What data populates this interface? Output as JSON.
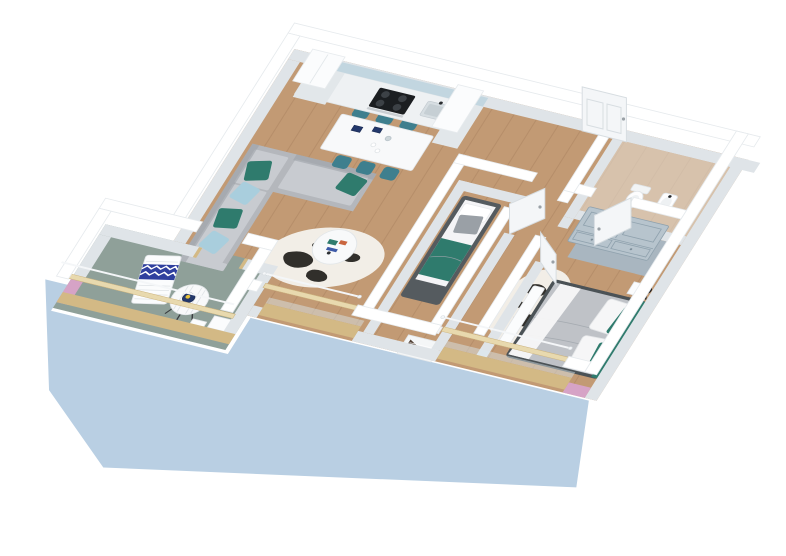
{
  "scene": {
    "label": "3D isometric floor plan render of a two-bedroom apartment with kitchen, living-dining room, child bedroom, master bedroom, bathroom, terrace and two balconies on a light blue walkway slab"
  },
  "palette": {
    "bg": "#ffffff",
    "wall_top": "#ffffff",
    "wall_face": "#dfe4e8",
    "wall_stroke": "#e6eaed",
    "wood": "#c29a74",
    "plank": "#7d5a3c",
    "bath_floor": "#e9e3da",
    "terrace_floor": "#8fa099",
    "slab": "#b9cfe3",
    "pink": "#d6a3c6",
    "railing_face": "#d3b985",
    "railing_top": "#e8d9ae",
    "handrail": "#f4f6f8",
    "door": "#f4f6f8",
    "door_edge": "#d7dde1",
    "sofa": "#b4b7bc",
    "sofa_light": "#c8cbd0",
    "sofa_dark": "#9aa0a6",
    "teal": "#2f7b6d",
    "teal_chair": "#3e7f8e",
    "pillow_blue": "#a9cedd",
    "table_white": "#f8f9fa",
    "cowhide": "#f2eee7",
    "spot": "#211e1b",
    "bedframe": "#555b5f",
    "bedframe2": "#4b5256",
    "mattress": "#f4f4f6",
    "duvet": "#bfc2c7",
    "cushion": "#9aa0a6",
    "wardrobe": "#b7c4cd",
    "wardrobe_line": "#90a2ae",
    "counter": "#eef1f3",
    "cabinet": "#fbfcfd",
    "backsplash": "#c2d6e0",
    "cooktop": "#1b1e21",
    "burner": "#3c4146",
    "steel": "#c9ced2",
    "sink_c": "#d7dee2",
    "lamp": "#1a1b1d",
    "towel": "#2f3f9e",
    "plate": "#23386b",
    "lemon": "#e8c23a",
    "radiator": "#f4f6f7",
    "radiator_slat": "#503f33",
    "glass": "#dceaf2"
  },
  "rooms": [
    {
      "name": "kitchen",
      "furniture": [
        "fridge tall cabinet",
        "counter with cooktop and oven",
        "sink",
        "tall cabinet",
        "blue backsplash"
      ]
    },
    {
      "name": "dining-area",
      "furniture": [
        "white dining table",
        "six teal chairs",
        "blue tableware"
      ]
    },
    {
      "name": "living-room",
      "furniture": [
        "gray corner sofa",
        "teal cushions",
        "patterned blue cushions",
        "round coffee table",
        "cowhide rug"
      ]
    },
    {
      "name": "child-bedroom",
      "furniture": [
        "single bed",
        "white pillow",
        "gray cushion",
        "teal blanket",
        "open door"
      ]
    },
    {
      "name": "bathroom",
      "furniture": [
        "toilet",
        "washbasin",
        "open door",
        "black bin"
      ]
    },
    {
      "name": "master-bedroom",
      "furniture": [
        "double bed with gray duvet",
        "teal pillows",
        "gray-blue wardrobe",
        "white bench",
        "nightstand",
        "black floor lamp",
        "cowhide rug",
        "open door"
      ]
    },
    {
      "name": "hallway",
      "furniture": [
        "entrance door"
      ]
    },
    {
      "name": "terrace",
      "furniture": [
        "sun lounger with blue zigzag towel",
        "round striped bistro table",
        "planter boxes"
      ]
    },
    {
      "name": "balconies",
      "furniture": [
        "wood and glass railings",
        "white handrails",
        "radiator niche",
        "pink accent pillars",
        "blue walkway slab"
      ]
    }
  ]
}
